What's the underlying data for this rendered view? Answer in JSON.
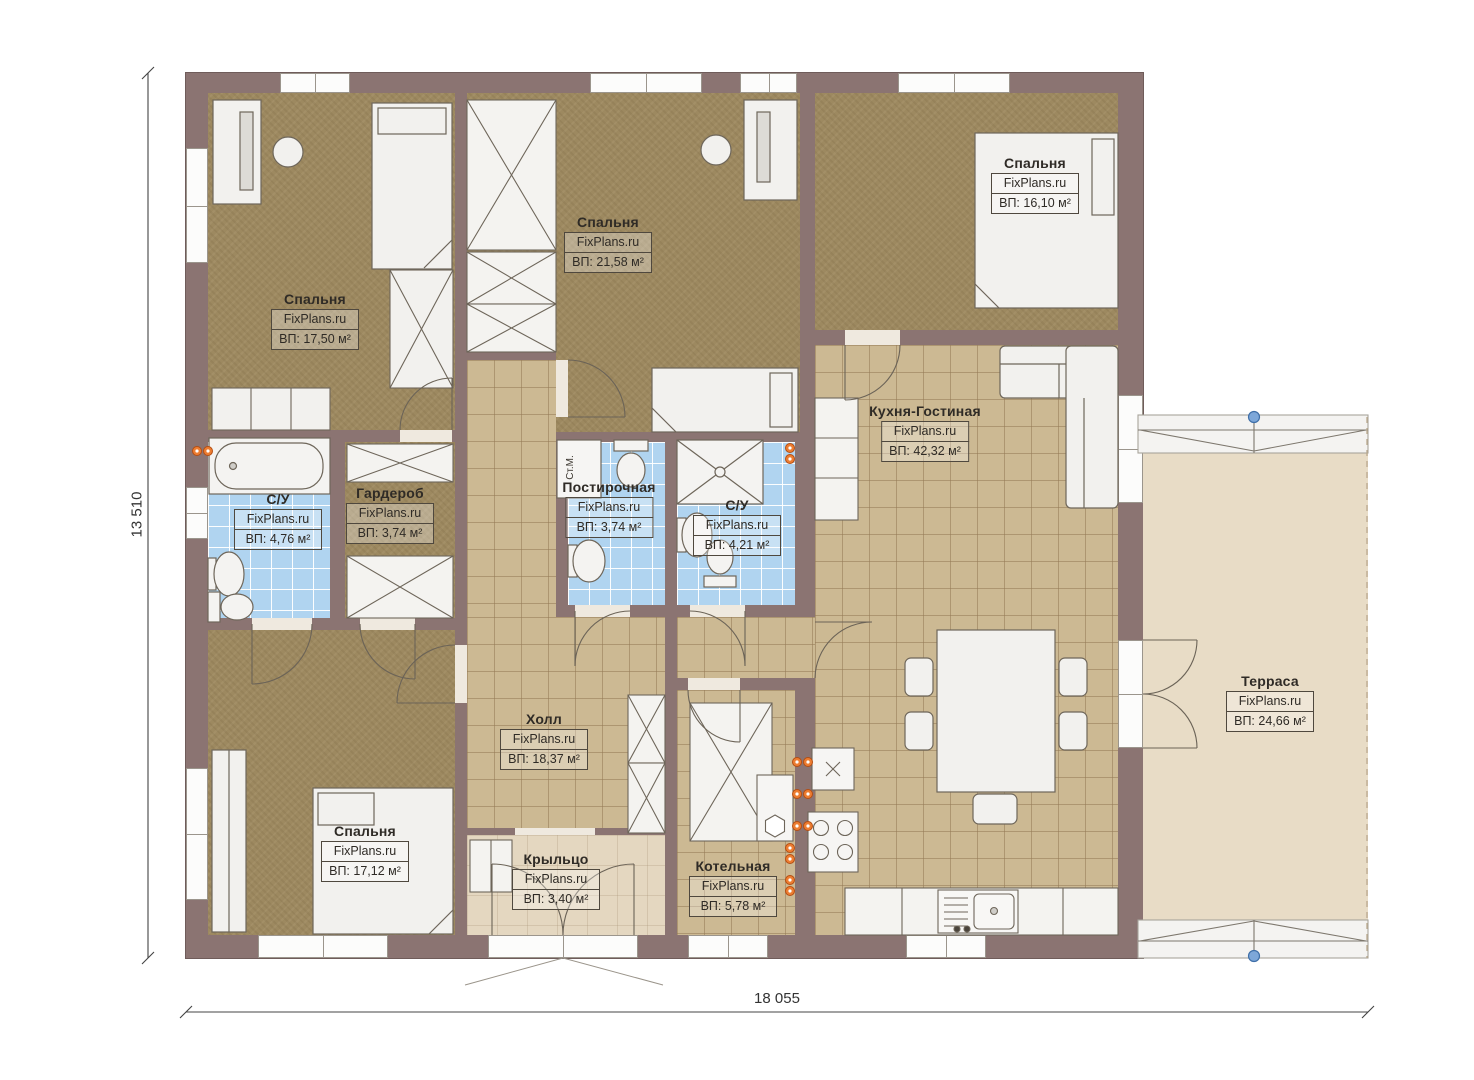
{
  "plan": {
    "watermark": "FixPlans.ru",
    "dimensions": {
      "width_label": "18 055",
      "height_label": "13 510"
    },
    "annotations": {
      "washing_machine": "Ст.М."
    },
    "rooms": [
      {
        "id": "bedroom-1",
        "name": "Спальня",
        "area": "ВП: 17,50 м²"
      },
      {
        "id": "bedroom-2",
        "name": "Спальня",
        "area": "ВП: 21,58 м²"
      },
      {
        "id": "bedroom-3",
        "name": "Спальня",
        "area": "ВП: 16,10 м²"
      },
      {
        "id": "kitchen-living",
        "name": "Кухня-Гостиная",
        "area": "ВП: 42,32 м²"
      },
      {
        "id": "bathroom-1",
        "name": "С/У",
        "area": "ВП: 4,76 м²"
      },
      {
        "id": "wardrobe",
        "name": "Гардероб",
        "area": "ВП: 3,74 м²"
      },
      {
        "id": "laundry",
        "name": "Постирочная",
        "area": "ВП: 3,74 м²"
      },
      {
        "id": "bathroom-2",
        "name": "С/У",
        "area": "ВП: 4,21 м²"
      },
      {
        "id": "hall",
        "name": "Холл",
        "area": "ВП: 18,37 м²"
      },
      {
        "id": "bedroom-4",
        "name": "Спальня",
        "area": "ВП: 17,12 м²"
      },
      {
        "id": "porch",
        "name": "Крыльцо",
        "area": "ВП: 3,40 м²"
      },
      {
        "id": "boiler",
        "name": "Котельная",
        "area": "ВП: 5,78 м²"
      },
      {
        "id": "terrace",
        "name": "Терраса",
        "area": "ВП: 24,66 м²"
      }
    ],
    "colors": {
      "wall": "#8b7472",
      "bedroom_floor": "#9d8960",
      "tile_floor": "#ccb993",
      "bath_floor": "#b0d4f0",
      "terrace_floor": "#e8dcc6",
      "porch_floor": "#e4d7c0",
      "outlet": "#ed7d31",
      "column_marker": "#7da7d9"
    }
  }
}
